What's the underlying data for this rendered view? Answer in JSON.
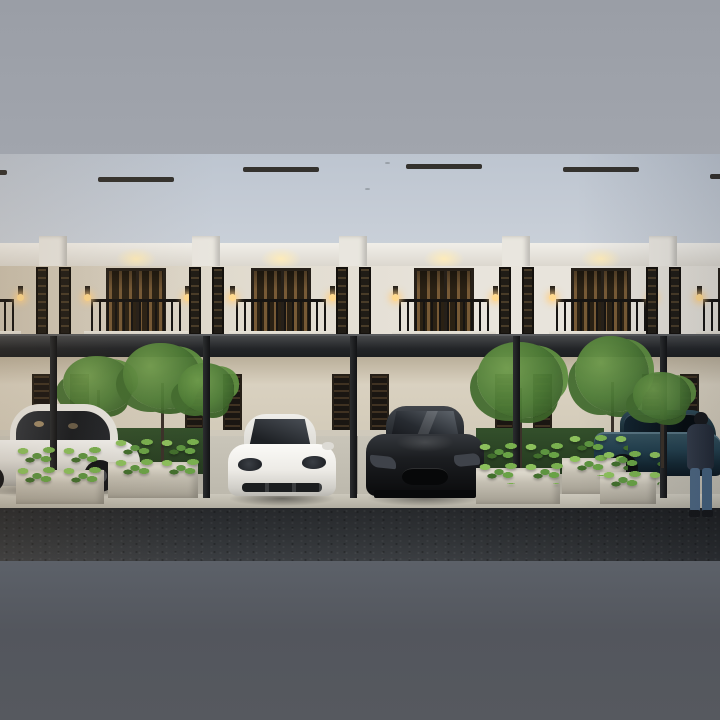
{
  "meta": {
    "description": "Dusk 3D architectural rendering of a row of modern classic two-story townhouses with dark mansard roofs, cream facades, lit balconies, a shared flat dark carport canopy, planters with shrubs and small trees, parked cars (white luxury sedan, white sports coupe, black sports car, dark blue sedan) and a man standing at the right; image letterboxed with gray bars top and bottom.",
    "letterboxed": true
  },
  "palette": {
    "border_top": "#9fa3ab",
    "border_bottom": "#54575e",
    "sky_top": "#bdc5d0",
    "sky_bottom": "#e6e8ec",
    "cornice_white": "#f1efe9",
    "wall_upper": "#e9e5dd",
    "wall_lower": "#d9d1c0",
    "canopy_dark": "#232528",
    "window_dark": "#201c16",
    "window_warm": "#775a36",
    "glow_warm": "#ffecb9",
    "railing_dark": "#161412",
    "plant_bright": "#8cc05c",
    "plant_dark": "#426f2d",
    "grass_dark": "#33502b",
    "planter_concrete": "#c4bfb2",
    "driveway": "#c9c5b9",
    "road_asphalt": "#2b2d30",
    "car_white": "#f3f2ef",
    "car_black": "#1b1d20",
    "car_blue": "#2c4856",
    "denim_blue": "#4d6782"
  },
  "scene": {
    "houses": [
      {
        "id": "unit-1-partial-left",
        "cx": -31,
        "roof_top_y": 20,
        "roof_a": "#4a3e35",
        "roof_b": "#362e28"
      },
      {
        "id": "unit-2",
        "cx": 136,
        "roof_top_y": 27,
        "roof_a": "#73604f",
        "roof_b": "#53453a"
      },
      {
        "id": "unit-3",
        "cx": 281,
        "roof_top_y": 17,
        "roof_a": "#6b5a4c",
        "roof_b": "#4c4037"
      },
      {
        "id": "unit-4",
        "cx": 444,
        "roof_top_y": 14,
        "roof_a": "#6f6b67",
        "roof_b": "#4f4c4b"
      },
      {
        "id": "unit-5",
        "cx": 601,
        "roof_top_y": 17,
        "roof_a": "#75747a",
        "roof_b": "#525156"
      },
      {
        "id": "unit-6-partial-right",
        "cx": 748,
        "roof_top_y": 24,
        "roof_a": "#5e5d63",
        "roof_b": "#46454b"
      }
    ],
    "canopy_posts_x": [
      53,
      206,
      353,
      516,
      663
    ],
    "grass_strips": [
      [
        66,
        204
      ],
      [
        476,
        604
      ]
    ],
    "planter_boxes": [
      [
        16,
        104,
        316,
        34
      ],
      [
        108,
        198,
        308,
        36
      ],
      [
        476,
        560,
        314,
        36
      ],
      [
        562,
        626,
        304,
        36
      ],
      [
        600,
        656,
        318,
        32
      ]
    ],
    "plant_patches": [
      [
        12,
        108,
        290,
        40
      ],
      [
        110,
        200,
        282,
        40
      ],
      [
        474,
        564,
        286,
        44
      ],
      [
        564,
        628,
        278,
        44
      ],
      [
        598,
        660,
        294,
        40
      ]
    ],
    "trees": [
      {
        "cx": 98,
        "cy": 230,
        "w": 70,
        "h": 56
      },
      {
        "cx": 162,
        "cy": 222,
        "w": 78,
        "h": 66
      },
      {
        "cx": 206,
        "cy": 234,
        "w": 56,
        "h": 50
      },
      {
        "cx": 520,
        "cy": 226,
        "w": 86,
        "h": 76
      },
      {
        "cx": 612,
        "cy": 220,
        "w": 74,
        "h": 76
      },
      {
        "cx": 662,
        "cy": 242,
        "w": 58,
        "h": 48,
        "front": true
      }
    ],
    "driveway_pads": [
      [
        -10,
        64
      ],
      [
        208,
        354
      ],
      [
        356,
        514
      ],
      [
        604,
        722
      ]
    ],
    "birds": [
      [
        365,
        34
      ],
      [
        385,
        8
      ]
    ],
    "cars": [
      {
        "name": "white-luxury-sedan",
        "color": "#e9e7e1",
        "position": "far-left-carport"
      },
      {
        "name": "white-sports-coupe",
        "color": "#f3f2ef",
        "position": "center-left-carport"
      },
      {
        "name": "black-sports-car",
        "color": "#1b1d20",
        "position": "center-right-carport"
      },
      {
        "name": "dark-blue-sedan",
        "color": "#2c4856",
        "position": "far-right-carport"
      }
    ],
    "person": {
      "name": "man-standing",
      "jacket": "#2b3340",
      "jeans": "#4d6782"
    }
  }
}
